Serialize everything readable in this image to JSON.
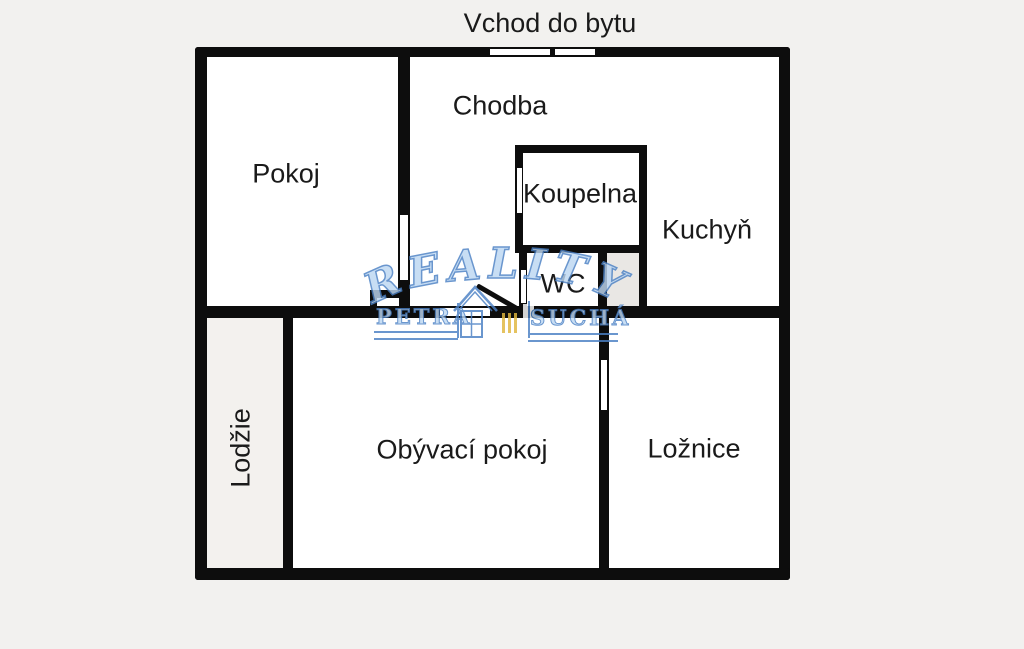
{
  "title": "Vchod do bytu",
  "rooms": {
    "pokoj": "Pokoj",
    "chodba": "Chodba",
    "koupelna": "Koupelna",
    "kuchyn": "Kuchyň",
    "wc": "WC",
    "lodzie": "Lodžie",
    "obyvaci_pokoj": "Obývací pokoj",
    "loznice": "Ložnice"
  },
  "watermark": {
    "reality_letters": [
      "R",
      "E",
      "A",
      "L",
      "I",
      "T",
      "Y"
    ],
    "name_left": "PETRA",
    "name_right": "SUCHÁ",
    "icons": {
      "house": "house-outline-icon",
      "bars": "triple-bars-icon"
    }
  },
  "colors": {
    "background": "#f2f1ef",
    "wall": "#0d0d0d",
    "room_fill": "#ffffff",
    "loggia_fill": "#f3f1ee",
    "shaft_fill": "#e9e7e4",
    "label_text": "#1a1a1a",
    "watermark_blue": "#4a80c4",
    "watermark_light_blue": "#bdd7f2",
    "watermark_yellow": "#e0b73e"
  }
}
